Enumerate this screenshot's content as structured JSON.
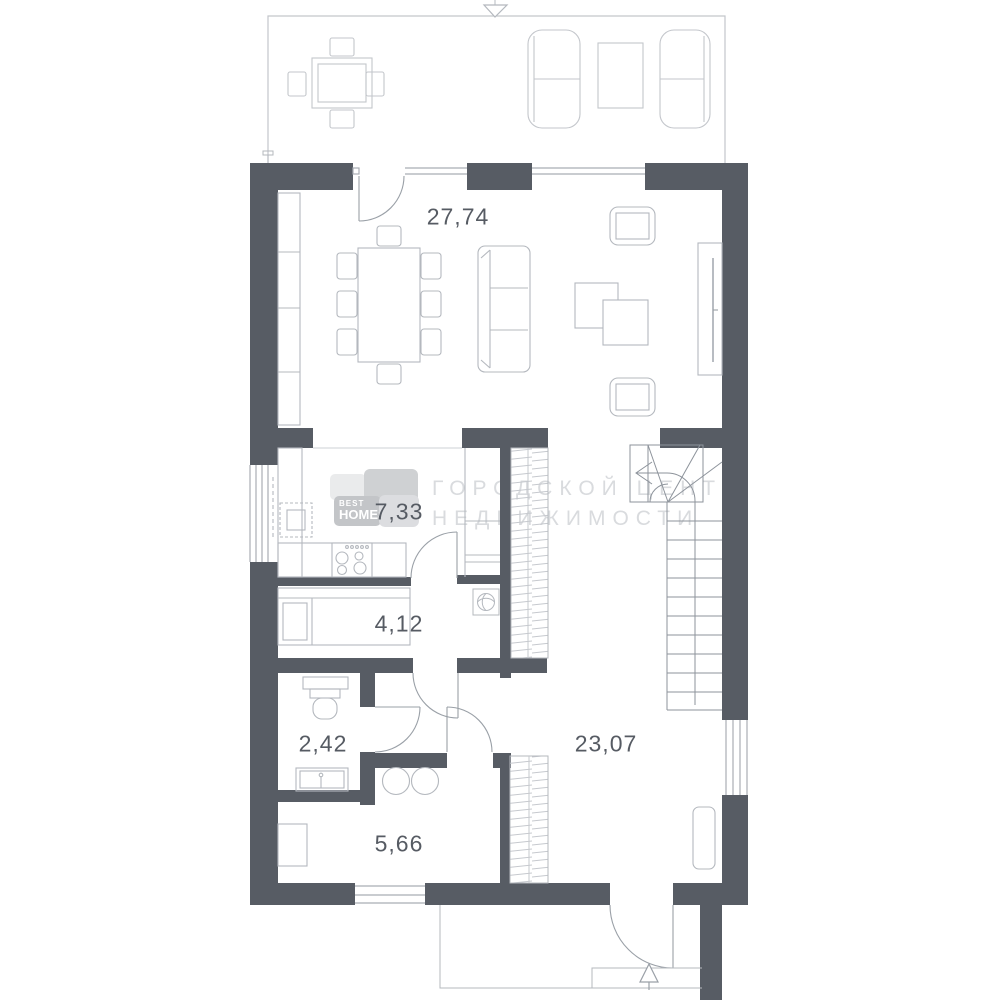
{
  "title": "floor-plan",
  "watermark": {
    "line1": "ГОРОДСКОЙ ЦЕНТР",
    "line2": "НЕДВИЖИМОСТИ"
  },
  "logo": {
    "best": "BEST",
    "homes": "HOMES"
  },
  "rooms": [
    {
      "id": "living-dining-room",
      "area_label": "27,74"
    },
    {
      "id": "kitchen",
      "area_label": "7,33"
    },
    {
      "id": "hallway",
      "area_label": "4,12"
    },
    {
      "id": "wc",
      "area_label": "2,42"
    },
    {
      "id": "bathroom",
      "area_label": "5,66"
    },
    {
      "id": "stair-hall",
      "area_label": "23,07"
    }
  ],
  "icons": {
    "entry_arrow": "up-triangle-entry-arrow",
    "terrace_marker": "down-triangle-boundary-marker",
    "stair_direction": "left-arrow-then-down-stair-guide",
    "fan": "ventilation-fan-icon"
  },
  "colors": {
    "wall": "#575c64",
    "furniture_line": "#b4b8be",
    "door_line": "#9aa0a7",
    "window_line": "#a9adb4",
    "terrace_line": "#c3c6cb",
    "watermark": "#d9dbde",
    "label": "#565b63",
    "logo_tile_light": "#eaebec",
    "logo_tile_mid": "#cfd1d3",
    "logo_tile_text_bg": "#c3c5c8"
  }
}
